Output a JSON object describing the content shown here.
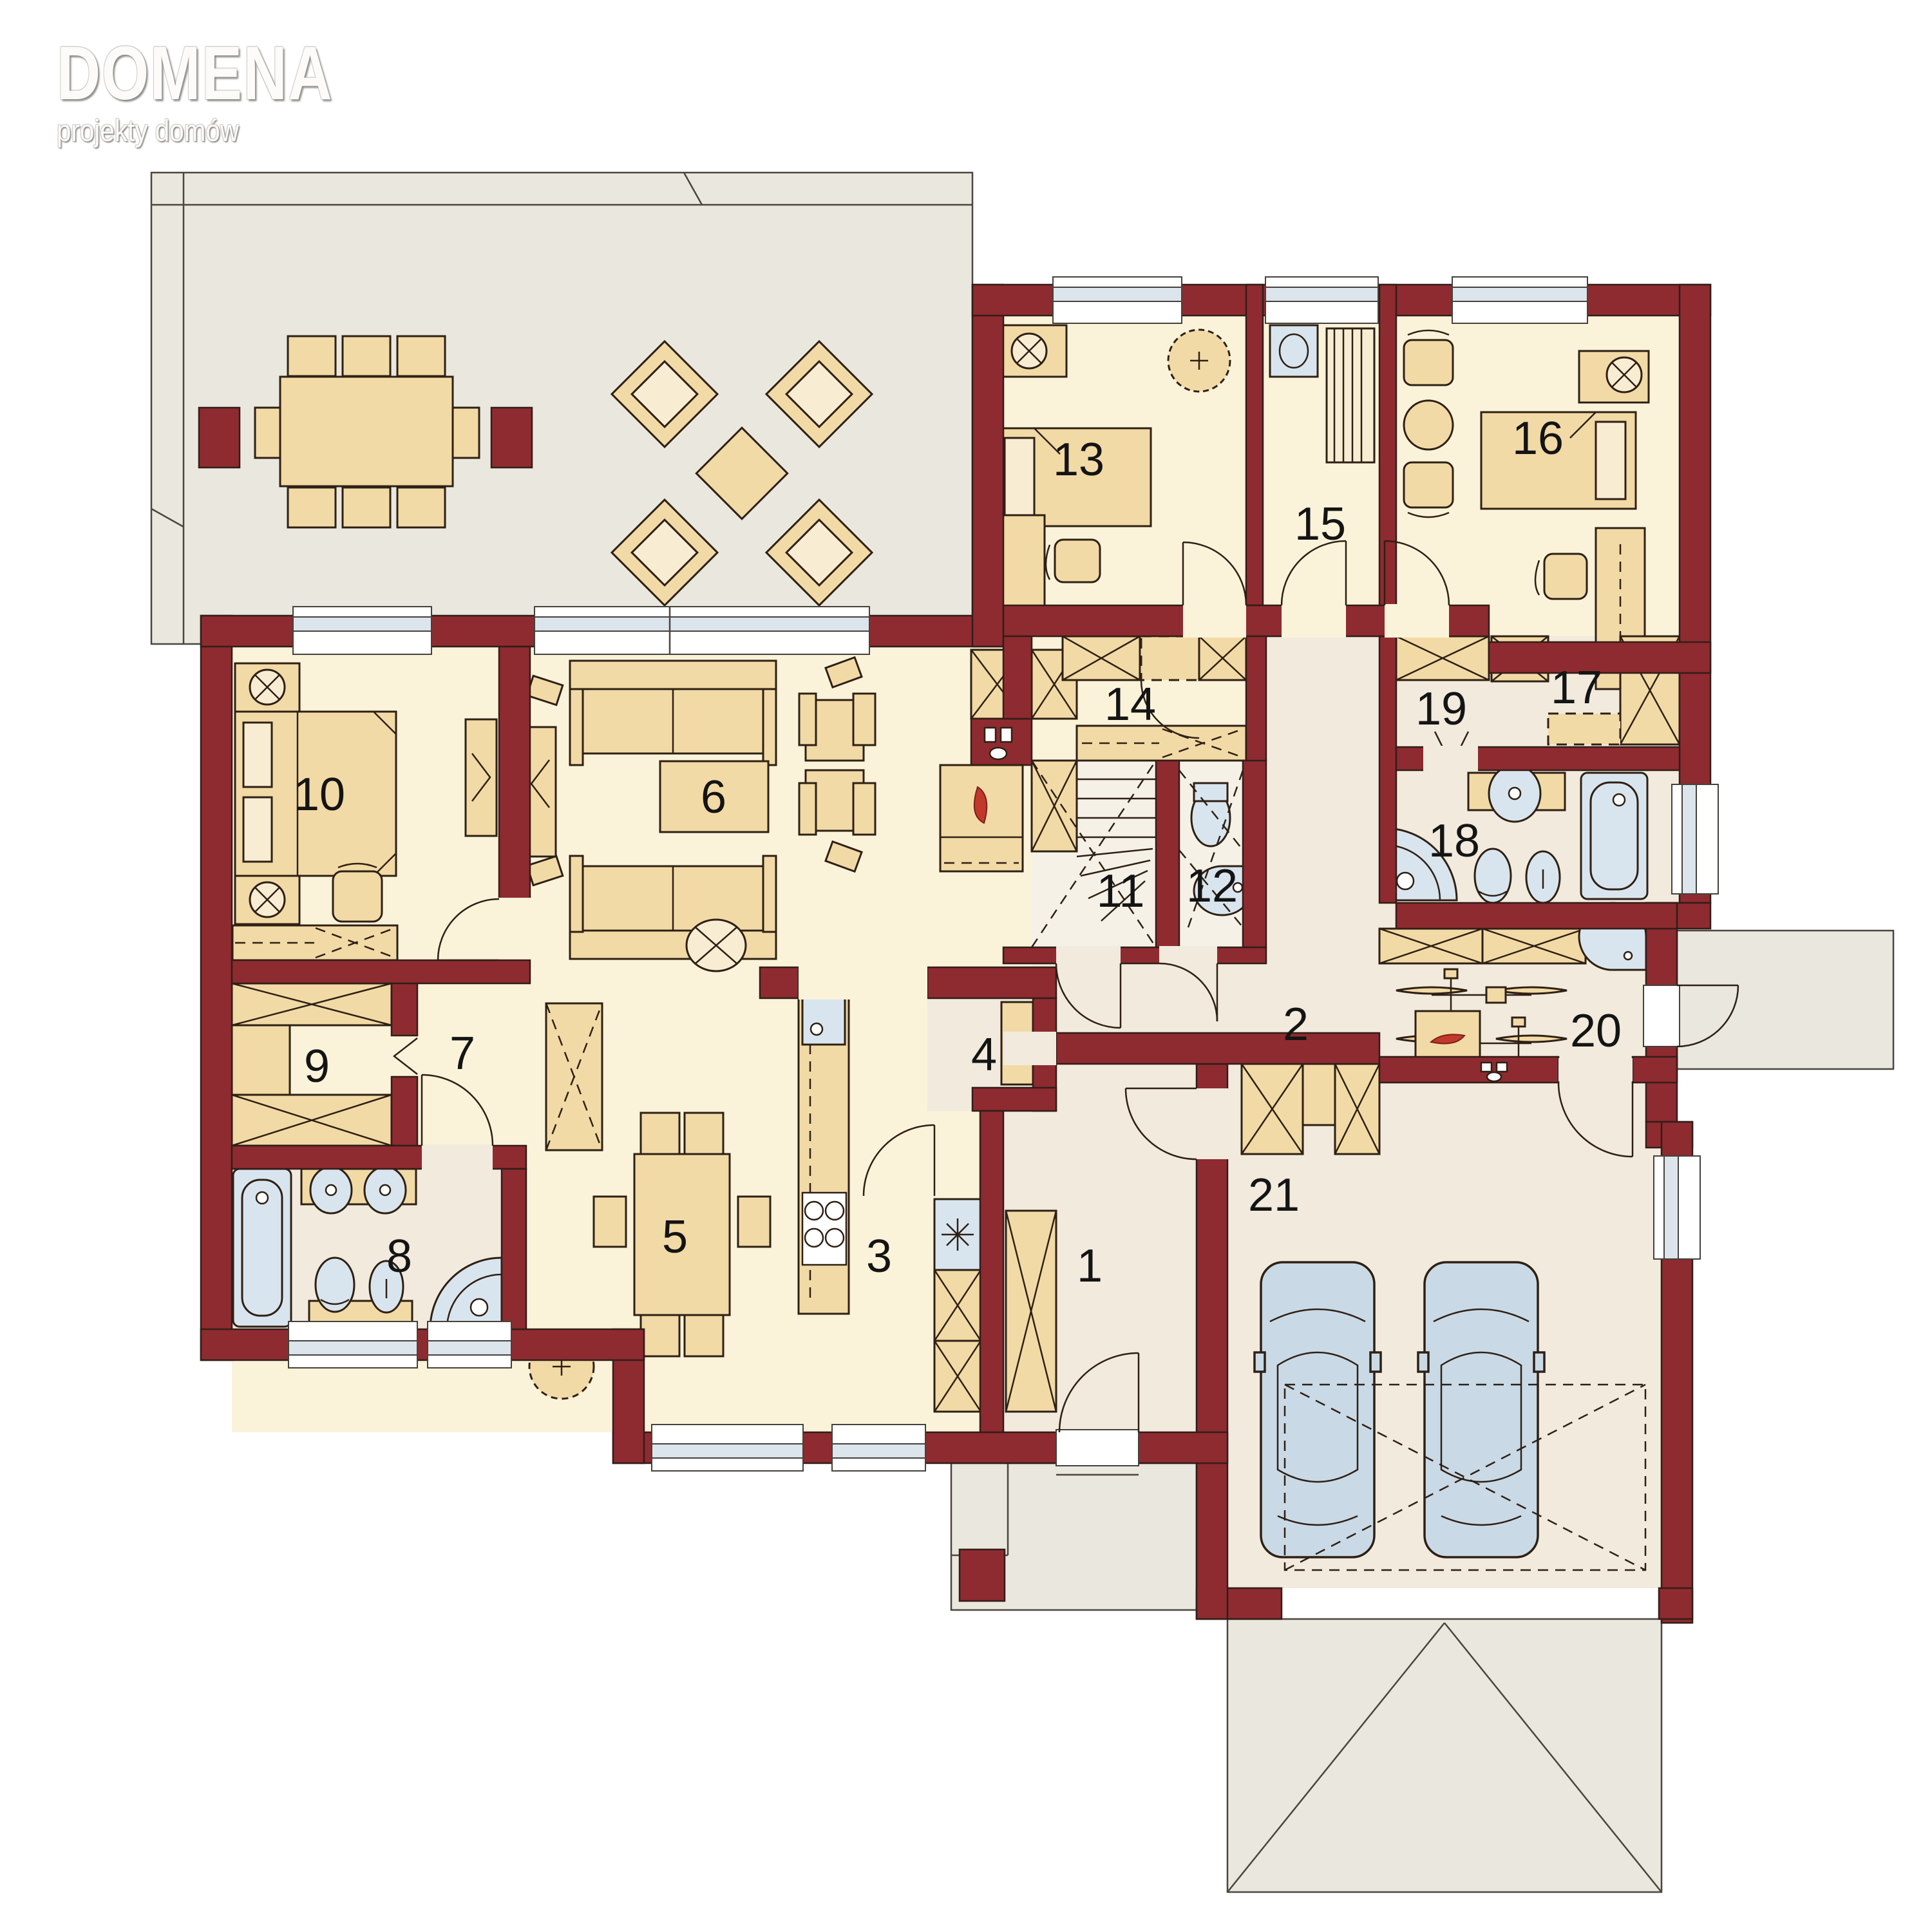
{
  "logo": {
    "title": "DOMENA",
    "subtitle": "projekty domów"
  },
  "rooms": {
    "r1": {
      "label": "1"
    },
    "r2": {
      "label": "2"
    },
    "r3": {
      "label": "3"
    },
    "r4": {
      "label": "4"
    },
    "r5": {
      "label": "5"
    },
    "r6": {
      "label": "6"
    },
    "r7": {
      "label": "7"
    },
    "r8": {
      "label": "8"
    },
    "r9": {
      "label": "9"
    },
    "r10": {
      "label": "10"
    },
    "r11": {
      "label": "11"
    },
    "r12": {
      "label": "12"
    },
    "r13": {
      "label": "13"
    },
    "r14": {
      "label": "14"
    },
    "r15": {
      "label": "15"
    },
    "r16": {
      "label": "16"
    },
    "r17": {
      "label": "17"
    },
    "r18": {
      "label": "18"
    },
    "r19": {
      "label": "19"
    },
    "r20": {
      "label": "20"
    },
    "r21": {
      "label": "21"
    }
  },
  "colors": {
    "wall": "#8E2B30",
    "room_cream": "#FAF3DA",
    "room_beige": "#F1EADD",
    "terrace": "#EAE7DE",
    "furniture": "#F2DAA6",
    "fixture_blue": "#D9E5EE",
    "car_blue": "#C9D9E6",
    "flame_red": "#C0392B",
    "outline": "#2E2014"
  }
}
